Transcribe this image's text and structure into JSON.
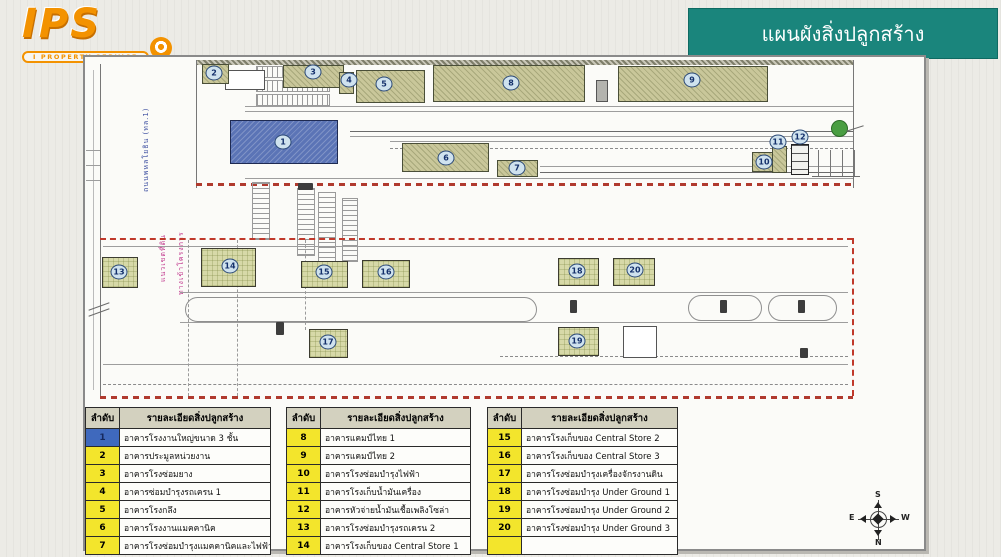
{
  "logo": {
    "text": "IPS",
    "subtext": "I PROPERTY SERVICE"
  },
  "banner": {
    "title": "แผนผังสิ่งปลูกสร้าง",
    "color": "#1a857c"
  },
  "plan": {
    "road_label": "ถนนพหลโยธิน (ทล.1)",
    "boundary_label_1": "แนวเขตที่ดิน",
    "boundary_label_2": "ทางเข้าโครงการ",
    "marker_labels": [
      "1",
      "2",
      "3",
      "4",
      "5",
      "6",
      "7",
      "8",
      "9",
      "10",
      "11",
      "12",
      "13",
      "14",
      "15",
      "16",
      "17",
      "18",
      "19",
      "20"
    ],
    "colors": {
      "building_main": "#5b74b6",
      "building_upper": "#c9c79a",
      "building_lower": "#d7d9a8",
      "boundary_red": "#c0392b"
    }
  },
  "tables": [
    {
      "header": {
        "no": "ลำดับ",
        "detail": "รายละเอียดสิ่งปลูกสร้าง"
      },
      "rows": [
        {
          "no": "1",
          "detail": "อาคารโรงงานใหญ่ขนาด 3 ชั้น"
        },
        {
          "no": "2",
          "detail": "อาคารประมูลหน่วยงาน"
        },
        {
          "no": "3",
          "detail": "อาคารโรงซ่อมยาง"
        },
        {
          "no": "4",
          "detail": "อาคารซ่อมบำรุงรถเครน 1"
        },
        {
          "no": "5",
          "detail": "อาคารโรงกลึง"
        },
        {
          "no": "6",
          "detail": "อาคารโรงงานแมคคานิค"
        },
        {
          "no": "7",
          "detail": "อาคารโรงซ่อมบำรุงแมคคานิคและไฟฟ้า"
        }
      ]
    },
    {
      "header": {
        "no": "ลำดับ",
        "detail": "รายละเอียดสิ่งปลูกสร้าง"
      },
      "rows": [
        {
          "no": "8",
          "detail": "อาคารแคมป์ไทย 1"
        },
        {
          "no": "9",
          "detail": "อาคารแคมป์ไทย 2"
        },
        {
          "no": "10",
          "detail": "อาคารโรงซ่อมบำรุงไฟฟ้า"
        },
        {
          "no": "11",
          "detail": "อาคารโรงเก็บน้ำมันเครื่อง"
        },
        {
          "no": "12",
          "detail": "อาคารหัวจ่ายน้ำมันเชื้อเพลิงโซล่า"
        },
        {
          "no": "13",
          "detail": "อาคารโรงซ่อมบำรุงรถเครน 2"
        },
        {
          "no": "14",
          "detail": "อาคารโรงเก็บของ Central Store 1"
        }
      ]
    },
    {
      "header": {
        "no": "ลำดับ",
        "detail": "รายละเอียดสิ่งปลูกสร้าง"
      },
      "rows": [
        {
          "no": "15",
          "detail": "อาคารโรงเก็บของ Central Store 2"
        },
        {
          "no": "16",
          "detail": "อาคารโรงเก็บของ Central Store 3"
        },
        {
          "no": "17",
          "detail": "อาคารโรงซ่อมบำรุงเครื่องจักรงานดิน"
        },
        {
          "no": "18",
          "detail": "อาคารโรงซ่อมบำรุง Under Ground 1"
        },
        {
          "no": "19",
          "detail": "อาคารโรงซ่อมบำรุง Under Ground 2"
        },
        {
          "no": "20",
          "detail": "อาคารโรงซ่อมบำรุง Under Ground 3"
        },
        {
          "no": "",
          "detail": ""
        }
      ]
    }
  ],
  "compass": {
    "top": "S",
    "bottom": "N",
    "left": "E",
    "right": "W"
  }
}
